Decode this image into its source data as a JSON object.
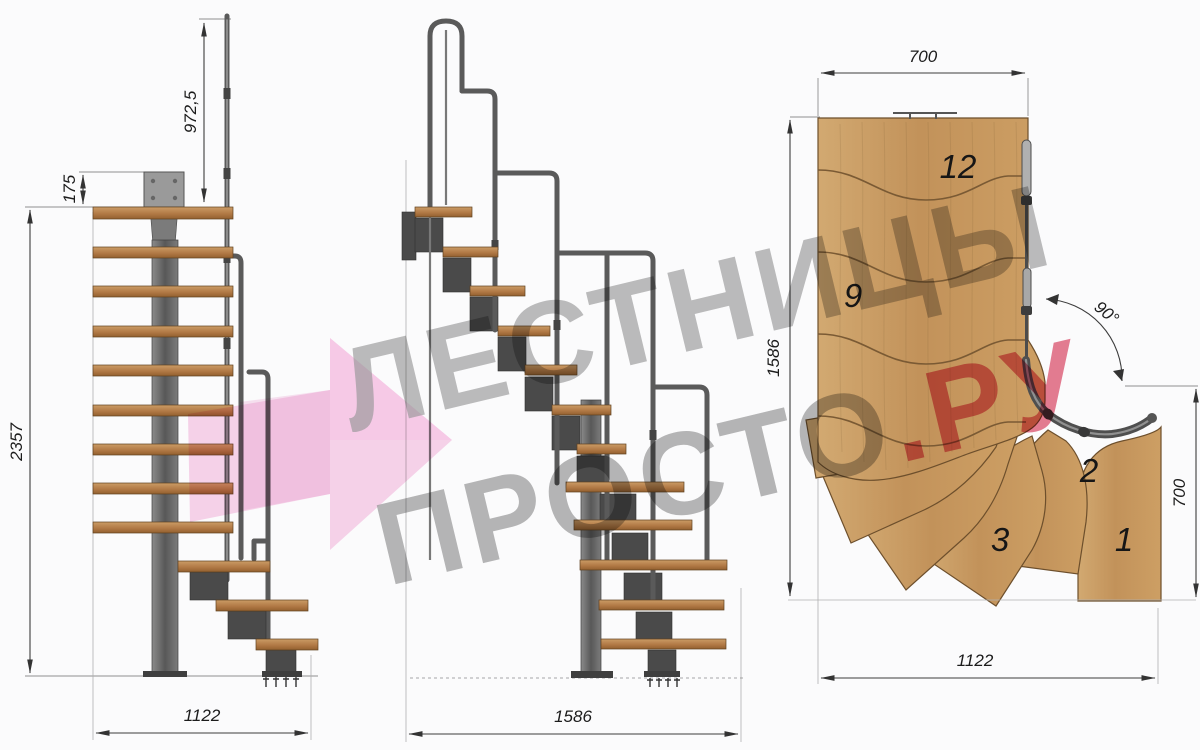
{
  "title": "Modular staircase technical drawing, three views",
  "watermark": {
    "line1": "ЛЕСТНИЦЫ",
    "line2_gray": "ПРОСТО",
    "line2_red": ".РУ",
    "gray_color": "#9b9b9b",
    "red_color": "#dd4b69",
    "pink_arrow_color": "#f3acd8"
  },
  "views": {
    "side": {
      "label": "side-elevation",
      "dims": {
        "rail_height": "972,5",
        "top_plate_offset": "175",
        "total_height": "2357",
        "base_width": "1122"
      }
    },
    "front": {
      "label": "front-elevation",
      "dims": {
        "base_width": "1586"
      }
    },
    "plan": {
      "label": "top-plan",
      "dims": {
        "top_width": "700",
        "left_depth": "1586",
        "right_depth": "700",
        "bottom_width": "1122",
        "turn_angle": "90°"
      },
      "tread_labels": [
        "12",
        "9",
        "2",
        "3",
        "1"
      ]
    }
  },
  "colors": {
    "wood_plan": "#c79d66",
    "wood_side": "#b5803f",
    "steel": "#4a4a4a",
    "dimension_lines": "#3c3c3c",
    "background": "#fbfbfc"
  }
}
